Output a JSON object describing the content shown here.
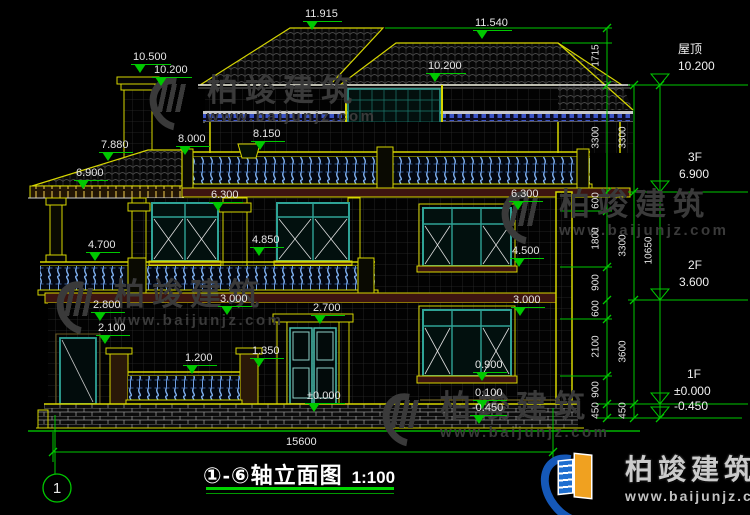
{
  "title": {
    "axis_range": "①-⑥",
    "drawing_name": "轴立面图",
    "scale": "1:100",
    "grid_bubble": "1"
  },
  "overall_width_dim": "15600",
  "floor_levels": {
    "roof": {
      "label": "屋顶",
      "elevation": "10.200"
    },
    "f3": {
      "label": "3F",
      "elevation": "6.900"
    },
    "f2": {
      "label": "2F",
      "elevation": "3.600"
    },
    "f1": {
      "label": "1F",
      "elevation": "±0.000"
    },
    "ground": {
      "elevation": "-0.450"
    }
  },
  "dim_chains": {
    "segments_inner": [
      "1715",
      "3300",
      "600",
      "1800",
      "900",
      "600",
      "2100",
      "900",
      "450"
    ],
    "segments_middle": [
      "3300",
      "3300",
      "3600",
      "450"
    ],
    "total": "10650"
  },
  "spot_elevations": {
    "ridge_left": "11.915",
    "ridge_right": "11.540",
    "main_eave": "10.200",
    "chimney_top": "10.500",
    "chimney_cap": "10.200",
    "porch_roof_peak": "7.880",
    "balcony3_rail": "8.000",
    "balcony3_post": "8.150",
    "porch_eave": "6.900",
    "win2_head_left": "6.300",
    "win2_head_right": "6.300",
    "rail2_top": "4.700",
    "win2_sill_center": "4.850",
    "win2_sill_right": "4.500",
    "win1_head_center": "3.000",
    "win1_head_right": "3.000",
    "rail1_top": "2.800",
    "door_head": "2.700",
    "rail1_mid": "2.100",
    "pier_cap": "1.350",
    "porch_rail": "1.200",
    "win1_sill_right": "0.900",
    "terrace": "0.100",
    "door_threshold": "±0.000",
    "ground_right": "-0.450"
  },
  "watermark": {
    "brand": "柏竣建筑",
    "url": "www.baijunjz.com"
  },
  "logo": {
    "brand": "柏竣建筑",
    "url": "www.baijunjz.com"
  },
  "colors": {
    "dimension_green": "#00c800",
    "cad_yellow": "#d6d600",
    "window_teal": "#2fa396",
    "baluster_blue": "#6f9fe0",
    "logo_blue": "#1558b8",
    "logo_orange": "#f0a120"
  }
}
